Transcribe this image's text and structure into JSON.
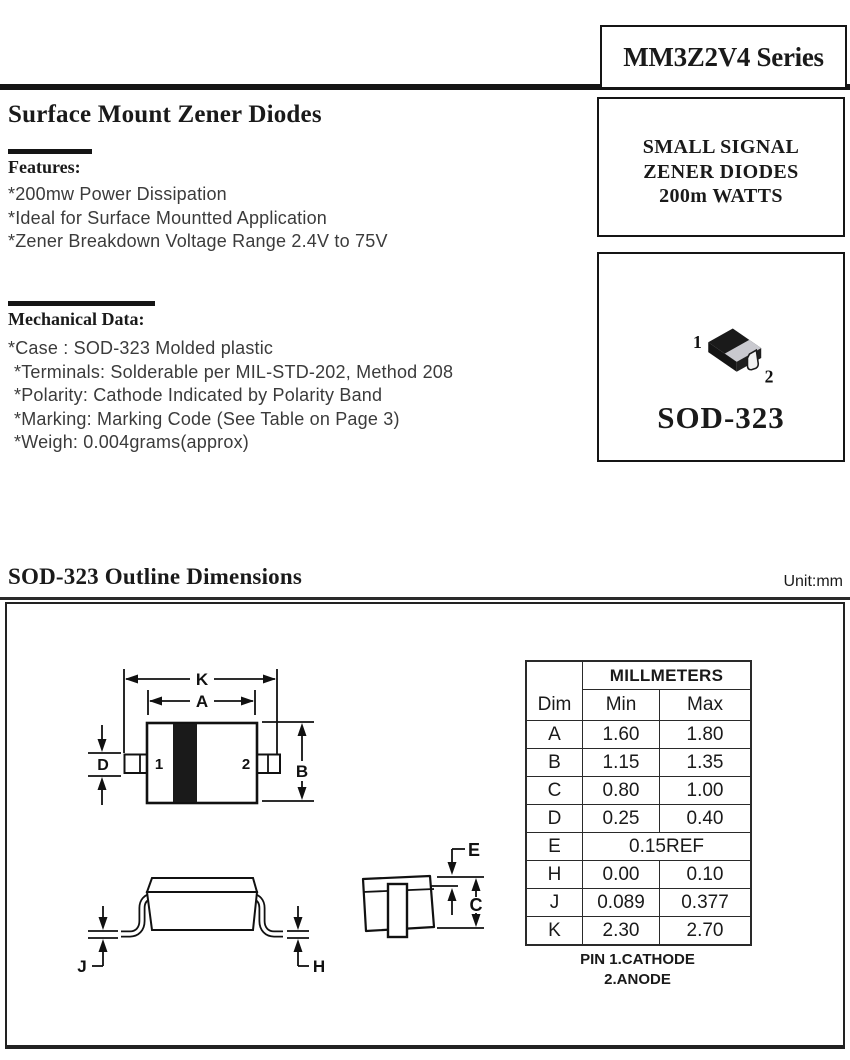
{
  "header": {
    "series_title": "MM3Z2V4 Series"
  },
  "intro": {
    "title": "Surface Mount Zener Diodes",
    "features": {
      "heading": "Features:",
      "items": [
        "*200mw Power Dissipation",
        "*Ideal for Surface Mountted Application",
        "*Zener Breakdown Voltage Range 2.4V to 75V"
      ]
    },
    "mechanical": {
      "heading": "Mechanical Data:",
      "items": [
        "*Case : SOD-323 Molded plastic",
        "*Terminals: Solderable per MIL-STD-202, Method 208",
        "*Polarity: Cathode Indicated by Polarity Band",
        "*Marking: Marking Code (See Table on Page 3)",
        "*Weigh: 0.004grams(approx)"
      ]
    }
  },
  "side_panel": {
    "signal_lines": [
      "SMALL SIGNAL",
      "ZENER DIODES",
      "200m WATTS"
    ],
    "package": {
      "pin1": "1",
      "pin2": "2",
      "name": "SOD-323"
    }
  },
  "outline": {
    "heading": "SOD-323 Outline Dimensions",
    "unit": "Unit:mm",
    "drawing": {
      "k": "K",
      "a": "A",
      "b": "B",
      "d": "D",
      "j": "J",
      "h": "H",
      "e": "E",
      "c": "C",
      "pin1": "1",
      "pin2": "2"
    },
    "table": {
      "group_header": "MILLMETERS",
      "columns": [
        "Dim",
        "Min",
        "Max"
      ],
      "rows": [
        {
          "dim": "A",
          "min": "1.60",
          "max": "1.80"
        },
        {
          "dim": "B",
          "min": "1.15",
          "max": "1.35"
        },
        {
          "dim": "C",
          "min": "0.80",
          "max": "1.00"
        },
        {
          "dim": "D",
          "min": "0.25",
          "max": "0.40"
        },
        {
          "dim": "E",
          "span": "0.15REF"
        },
        {
          "dim": "H",
          "min": "0.00",
          "max": "0.10"
        },
        {
          "dim": "J",
          "min": "0.089",
          "max": "0.377"
        },
        {
          "dim": "K",
          "min": "2.30",
          "max": "2.70"
        }
      ]
    },
    "pin_note_lines": [
      "PIN 1.CATHODE",
      "2.ANODE"
    ]
  },
  "colors": {
    "ink": "#1a1a1a",
    "body_text": "#3b3b3b",
    "band_gray": "#c9c9cf"
  }
}
